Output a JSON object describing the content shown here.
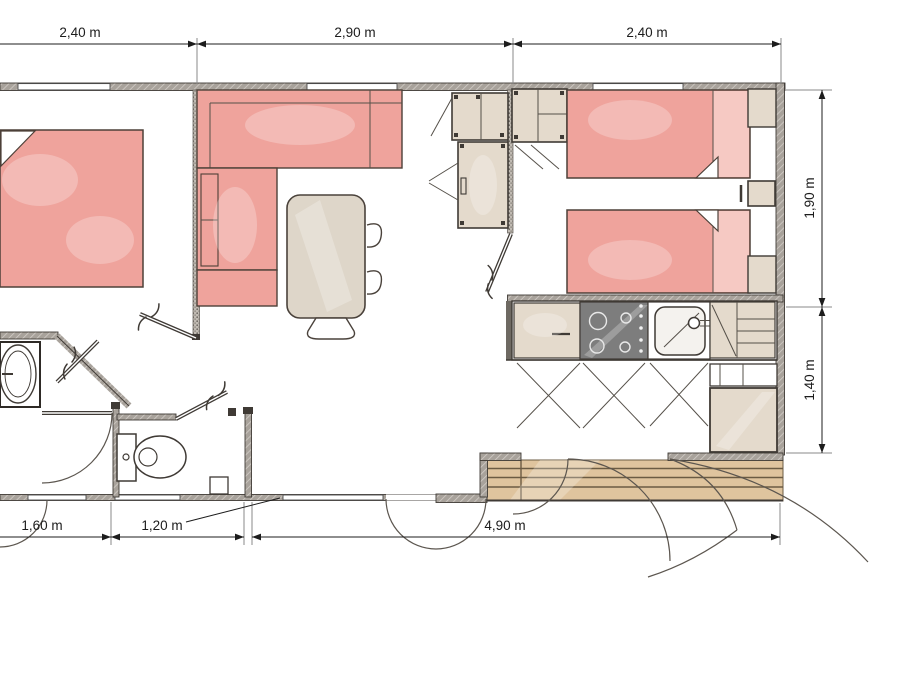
{
  "plan": {
    "type": "mobile-home floor plan",
    "dims_top": [
      {
        "label": "2,40 m"
      },
      {
        "label": "2,90 m"
      },
      {
        "label": "2,40 m"
      }
    ],
    "dims_right": [
      {
        "label": "1,90 m"
      },
      {
        "label": "1,40 m"
      }
    ],
    "dims_bottom": [
      {
        "label": "1,60 m"
      },
      {
        "label": "1,20 m"
      },
      {
        "label": "4,90 m"
      }
    ],
    "colors": {
      "furniture_pink": "#efa39c",
      "furniture_pink_light": "#f6c9c3",
      "cabinet_beige": "#e4dacc",
      "table_beige": "#ded6c9",
      "deck_wood": "#dfc49e",
      "wall_gray": "#a39d96",
      "hob_gray": "#7d7d7d",
      "line_dark": "#3f3a35"
    }
  }
}
